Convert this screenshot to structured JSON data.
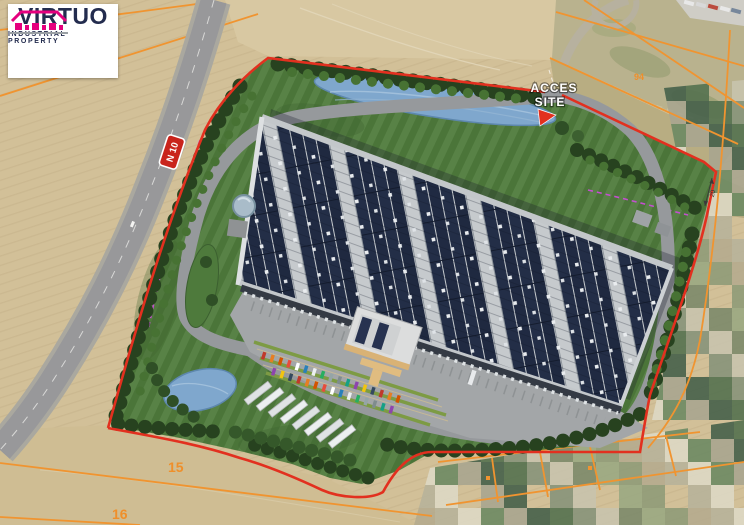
{
  "window": {
    "title": "VIRTUO industrial property - site masterplan aerial view"
  },
  "logo": {
    "name": "VIRTUO",
    "tagline": "INDUSTRIAL PROPERTY"
  },
  "annotations": {
    "access": {
      "line1": "ACCES",
      "line2": "SITE"
    },
    "road_sign": "N 10",
    "parcel_15": "15",
    "parcel_16": "16",
    "parcel_94": "94",
    "dimension_20": "20"
  },
  "colors": {
    "brand_magenta": "#e5007e",
    "logo_navy": "#232c4e",
    "boundary_red": "#e2301f",
    "cadastral_orange": "#f09430",
    "path_purple": "#c44fd0",
    "pond_blue": "#7fa7cd",
    "roof_panel_navy": "#232e47",
    "grass_green": "#4e7a3c",
    "asphalt_gray": "#97999b",
    "farmland_tan": "#d2c098",
    "car_palette": [
      "#c0392b",
      "#2980b9",
      "#16a085",
      "#e67e22",
      "#ecf0f1",
      "#8e44ad",
      "#d35400",
      "#27ae60",
      "#f1c40f",
      "#e74c3c",
      "#95a5a6",
      "#34495e",
      "#ffffff",
      "#7f8c8d"
    ],
    "mosaic_palette": [
      "#a8a58f",
      "#8f9b78",
      "#54714f",
      "#b7b29a",
      "#c8c3ad",
      "#6d8a63",
      "#9aa882",
      "#46604a",
      "#b5ab8e",
      "#87937a",
      "#ddd8c4",
      "#7c8a6a"
    ]
  }
}
